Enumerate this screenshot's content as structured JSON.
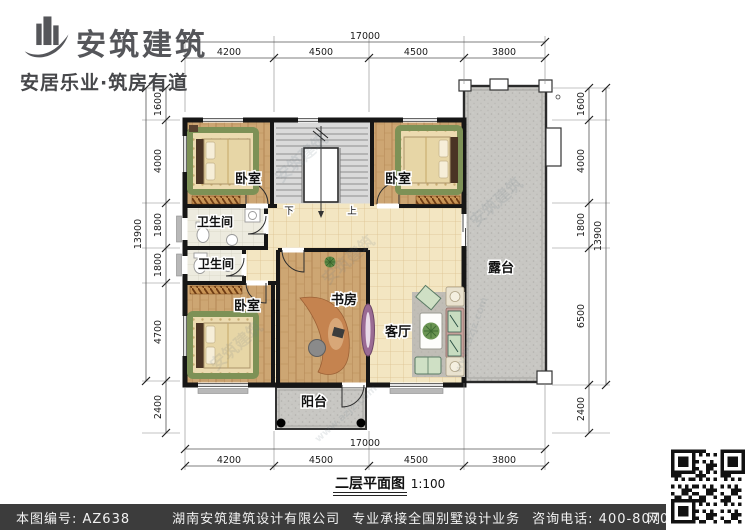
{
  "header": {
    "brand": "安筑建筑",
    "tagline": "安居乐业·筑房有道"
  },
  "plan": {
    "title": "二层平面图",
    "scale": "1:100",
    "rooms": {
      "bedroom_top_left": "卧室",
      "bedroom_top_right": "卧室",
      "bedroom_bottom_left": "卧室",
      "bathroom_upper": "卫生间",
      "bathroom_lower": "卫生间",
      "study": "书房",
      "living_room": "客厅",
      "terrace": "露台",
      "balcony": "阳台"
    },
    "stairs": {
      "down": "下",
      "up": "上"
    },
    "watermark": "安筑建筑",
    "watermark_site": "www.azjz.com"
  },
  "dimensions": {
    "top": {
      "total": "17000",
      "segments": [
        "4200",
        "4500",
        "4500",
        "3800"
      ]
    },
    "bottom": {
      "total": "17000",
      "segments": [
        "4200",
        "4500",
        "4500",
        "3800"
      ]
    },
    "left": {
      "total": "13900",
      "segments": [
        "1600",
        "4000",
        "1800",
        "1800",
        "4700",
        "2400"
      ]
    },
    "right": {
      "total": "13900",
      "segments": [
        "1600",
        "4000",
        "1800",
        "6500",
        "2400"
      ]
    }
  },
  "footer": {
    "plan_no": "本图编号: AZ638",
    "company": "湖南安筑建筑设计有限公司",
    "service": "专业承接全国别墅设计业务",
    "phone": "咨询电话: 400-8070-511",
    "web": "网"
  },
  "colors": {
    "wall": "#161616",
    "wood_floor": "#cda673",
    "tile_floor": "#f3e6c2",
    "terrace_gray": "#c8c7c3",
    "footer_bg": "#3c3c3c"
  }
}
